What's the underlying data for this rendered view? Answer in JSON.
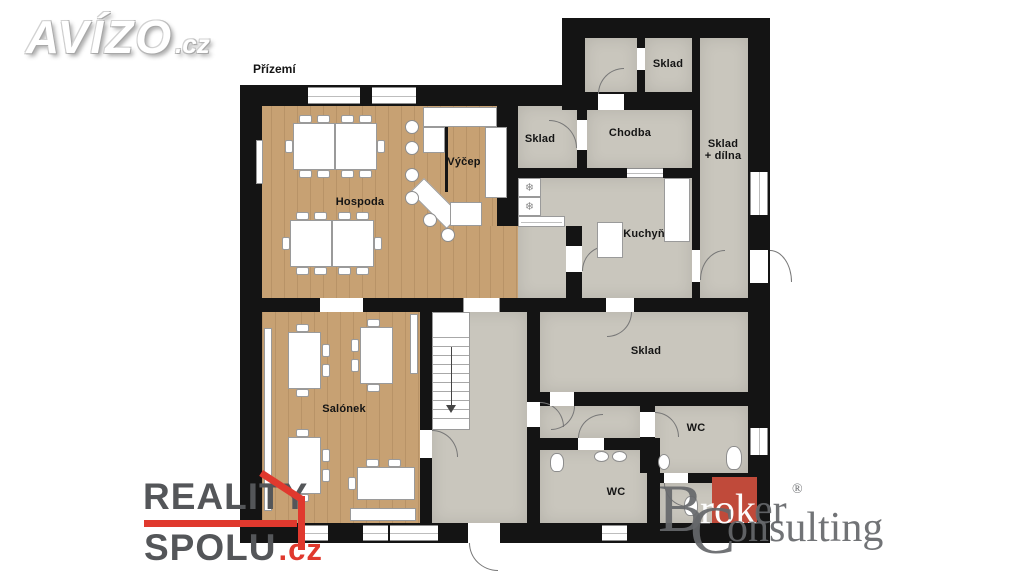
{
  "page": {
    "title": "Přízemí"
  },
  "rooms": [
    {
      "label": "Hospoda",
      "x": 360,
      "y": 202
    },
    {
      "label": "Výčep",
      "x": 464,
      "y": 162
    },
    {
      "label": "Sklad",
      "x": 540,
      "y": 139
    },
    {
      "label": "Chodba",
      "x": 630,
      "y": 133
    },
    {
      "label": "Sklad",
      "x": 668,
      "y": 64
    },
    {
      "label": "Sklad\n+ dílna",
      "x": 723,
      "y": 150
    },
    {
      "label": "Kuchyň",
      "x": 644,
      "y": 234
    },
    {
      "label": "Sklad",
      "x": 646,
      "y": 351
    },
    {
      "label": "Salónek",
      "x": 344,
      "y": 409
    },
    {
      "label": "WC",
      "x": 696,
      "y": 428
    },
    {
      "label": "WC",
      "x": 616,
      "y": 492
    }
  ],
  "glyphs": {
    "freezer": "❄"
  },
  "logos": {
    "avizo": {
      "word": "AVÍZO",
      "tld": ".cz"
    },
    "reality": {
      "line1": "REALITY",
      "line2": "SPOLU",
      "tld": ".cz"
    },
    "broker": {
      "b": "B",
      "rok": "rok",
      "er": "er",
      "reg": "®",
      "c": "C",
      "onsulting": "onsulting"
    }
  },
  "colors": {
    "wall": "#141414",
    "wood_floor": "#c7a173",
    "gray_floor": "#c9c6bd",
    "reality_red": "#e0392e",
    "broker_red": "#c04a3a"
  }
}
